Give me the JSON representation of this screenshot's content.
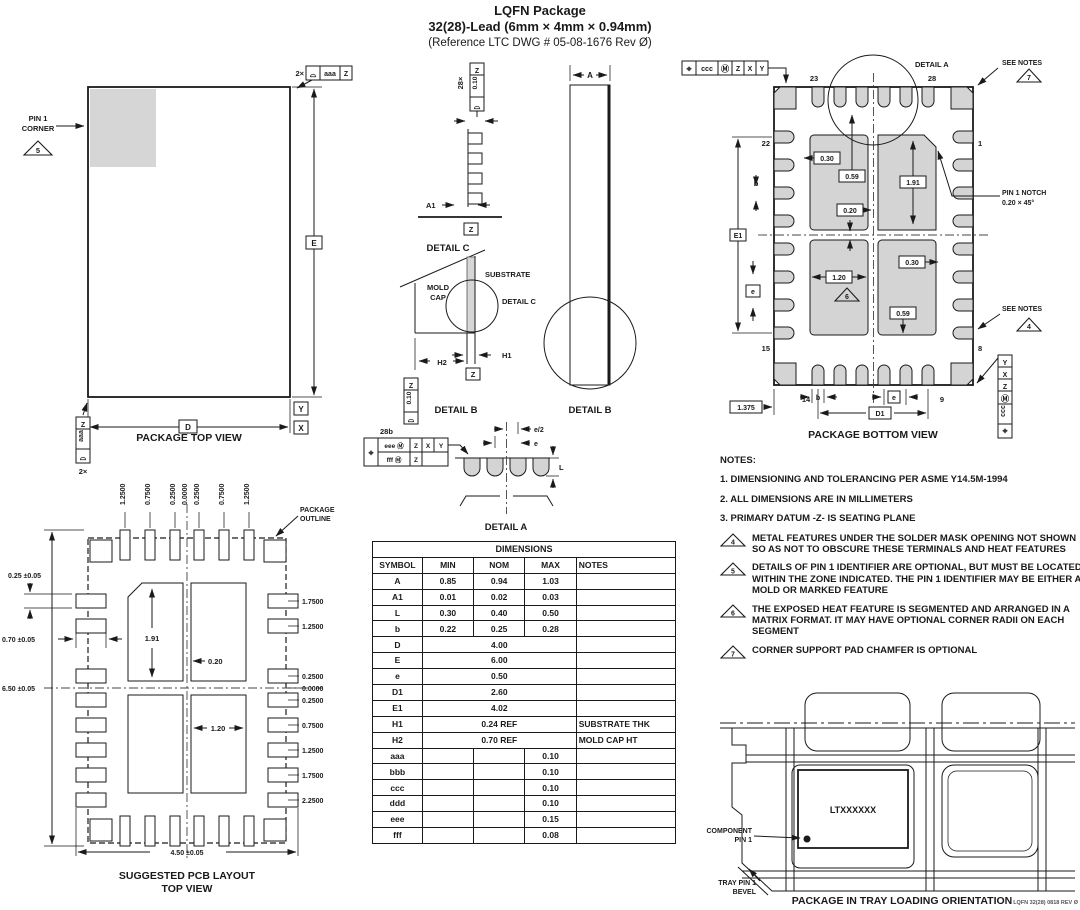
{
  "title": {
    "line1": "LQFN Package",
    "line2": "32(28)-Lead (6mm × 4mm × 0.94mm)",
    "line3": "(Reference LTC DWG # 05-08-1676 Rev Ø)"
  },
  "top_view": {
    "caption": "PACKAGE TOP VIEW",
    "pin1_line1": "PIN 1",
    "pin1_line2": "CORNER",
    "pin1_flag": "5",
    "qty_top": "2×",
    "fcf_top_symbol": "⌓",
    "fcf_top_tol": "aaa",
    "fcf_top_datum": "Z",
    "qty_left": "2×",
    "fcf_left_symbol": "⌓",
    "fcf_left_tol": "aaa",
    "fcf_left_datum": "Z",
    "dim_e": "E",
    "dim_d": "D",
    "datum_x": "X",
    "datum_y": "Y"
  },
  "detail_c": {
    "qty": "28×",
    "fcf_symbol": "⌓",
    "fcf_tol": "0.10",
    "fcf_datum": "Z",
    "dim_a1": "A1",
    "datum_z": "Z",
    "caption": "DETAIL C"
  },
  "side_view": {
    "dim_a": "A",
    "caption": "DETAIL B"
  },
  "detail_b": {
    "mold1": "MOLD",
    "mold2": "CAP",
    "substrate": "SUBSTRATE",
    "detail_c_ref": "DETAIL C",
    "dim_h1": "H1",
    "dim_h2": "H2",
    "fcf_symbol": "⌓",
    "fcf_tol": "0.10",
    "fcf_datum": "Z",
    "datum_z": "Z",
    "caption": "DETAIL B"
  },
  "detail_a": {
    "qty": "28b",
    "fcf_pos": "⌖",
    "fcf_r1_tol": "eee Ⓜ",
    "fcf_r1_d1": "Z",
    "fcf_r1_d2": "X",
    "fcf_r1_d3": "Y",
    "fcf_r2_tol": "fff Ⓜ",
    "fcf_r2_d1": "Z",
    "dim_e_half": "e/2",
    "dim_e": "e",
    "dim_l": "L",
    "caption": "DETAIL A"
  },
  "bottom_view": {
    "caption": "PACKAGE BOTTOM VIEW",
    "fcf_pos": "⌖",
    "fcf_tol": "ccc",
    "fcf_mod": "Ⓜ",
    "fcf_d1": "Z",
    "fcf_d2": "X",
    "fcf_d3": "Y",
    "detail_a_ref": "DETAIL A",
    "see_notes": "SEE NOTES",
    "flag7": "7",
    "flag4": "4",
    "flag6": "6",
    "pin1_notch1": "PIN 1 NOTCH",
    "pin1_notch2": "0.20 × 45°",
    "pin23": "23",
    "pin28": "28",
    "pin22": "22",
    "pin1": "1",
    "pin15": "15",
    "pin8": "8",
    "pin14": "14",
    "pin9": "9",
    "dim_030a": "0.30",
    "dim_059a": "0.59",
    "dim_191": "1.91",
    "dim_020": "0.20",
    "dim_120": "1.20",
    "dim_030b": "0.30",
    "dim_059b": "0.59",
    "dim_e1": "E1",
    "dim_b_left": "b",
    "dim_e_left": "e",
    "dim_edge": "1.375",
    "dim_b_bot": "b",
    "dim_e_bot": "e",
    "dim_d1": "D1"
  },
  "notes": {
    "heading": "NOTES:",
    "n1": "1. DIMENSIONING AND TOLERANCING PER ASME Y14.5M-1994",
    "n2": "2. ALL DIMENSIONS ARE IN MILLIMETERS",
    "n3": "3. PRIMARY DATUM -Z- IS SEATING PLANE",
    "f4": "4",
    "n4": "METAL FEATURES UNDER THE SOLDER MASK OPENING NOT SHOWN SO AS NOT TO  OBSCURE THESE TERMINALS AND HEAT FEATURES",
    "f5": "5",
    "n5": "DETAILS OF PIN 1 IDENTIFIER ARE OPTIONAL, BUT MUST BE LOCATED WITHIN THE ZONE INDICATED. THE PIN 1 IDENTIFIER MAY BE EITHER A MOLD OR MARKED FEATURE",
    "f6": "6",
    "n6": "THE EXPOSED HEAT FEATURE IS SEGMENTED AND ARRANGED IN A MATRIX FORMAT. IT MAY HAVE OPTIONAL CORNER RADII ON EACH SEGMENT",
    "f7": "7",
    "n7": "CORNER SUPPORT PAD CHAMFER IS OPTIONAL"
  },
  "table": {
    "title": "DIMENSIONS",
    "headers": {
      "symbol": "SYMBOL",
      "min": "MIN",
      "nom": "NOM",
      "max": "MAX",
      "notes": "NOTES"
    },
    "rows": [
      {
        "sym": "A",
        "min": "0.85",
        "nom": "0.94",
        "max": "1.03",
        "notes": ""
      },
      {
        "sym": "A1",
        "min": "0.01",
        "nom": "0.02",
        "max": "0.03",
        "notes": ""
      },
      {
        "sym": "L",
        "min": "0.30",
        "nom": "0.40",
        "max": "0.50",
        "notes": ""
      },
      {
        "sym": "b",
        "min": "0.22",
        "nom": "0.25",
        "max": "0.28",
        "notes": ""
      },
      {
        "sym": "D",
        "span": "4.00",
        "notes": ""
      },
      {
        "sym": "E",
        "span": "6.00",
        "notes": ""
      },
      {
        "sym": "e",
        "span": "0.50",
        "notes": ""
      },
      {
        "sym": "D1",
        "span": "2.60",
        "notes": ""
      },
      {
        "sym": "E1",
        "span": "4.02",
        "notes": ""
      },
      {
        "sym": "H1",
        "span": "0.24 REF",
        "notes": "SUBSTRATE THK"
      },
      {
        "sym": "H2",
        "span": "0.70 REF",
        "notes": "MOLD CAP HT"
      },
      {
        "sym": "aaa",
        "min": "",
        "nom": "",
        "max": "0.10",
        "notes": ""
      },
      {
        "sym": "bbb",
        "min": "",
        "nom": "",
        "max": "0.10",
        "notes": ""
      },
      {
        "sym": "ccc",
        "min": "",
        "nom": "",
        "max": "0.10",
        "notes": ""
      },
      {
        "sym": "ddd",
        "min": "",
        "nom": "",
        "max": "0.10",
        "notes": ""
      },
      {
        "sym": "eee",
        "min": "",
        "nom": "",
        "max": "0.15",
        "notes": ""
      },
      {
        "sym": "fff",
        "min": "",
        "nom": "",
        "max": "0.08",
        "notes": ""
      }
    ]
  },
  "pcb": {
    "caption1": "SUGGESTED PCB LAYOUT",
    "caption2": "TOP VIEW",
    "outline1": "PACKAGE",
    "outline2": "OUTLINE",
    "top_labels": [
      "1.2500",
      "0.7500",
      "0.2500",
      "0.0000",
      "0.2500",
      "0.7500",
      "1.2500"
    ],
    "right_labels": [
      "1.7500",
      "1.2500",
      "0.2500",
      "0.0000",
      "0.2500",
      "0.7500",
      "1.2500",
      "1.7500",
      "2.2500"
    ],
    "dim_pad_h": "0.25 ±0.05",
    "dim_pad_w": "0.70 ±0.05",
    "dim_total_h": "6.50 ±0.05",
    "dim_total_w": "4.50 ±0.05",
    "dim_191": "1.91",
    "dim_020": "0.20",
    "dim_120": "1.20"
  },
  "tray": {
    "chip": "LTXXXXXX",
    "comp1": "COMPONENT",
    "comp2": "PIN 1",
    "bevel1": "TRAY PIN 1",
    "bevel2": "BEVEL",
    "caption": "PACKAGE IN TRAY LOADING ORIENTATION",
    "rev": "LQFN 32(28) 0818 REV Ø"
  }
}
